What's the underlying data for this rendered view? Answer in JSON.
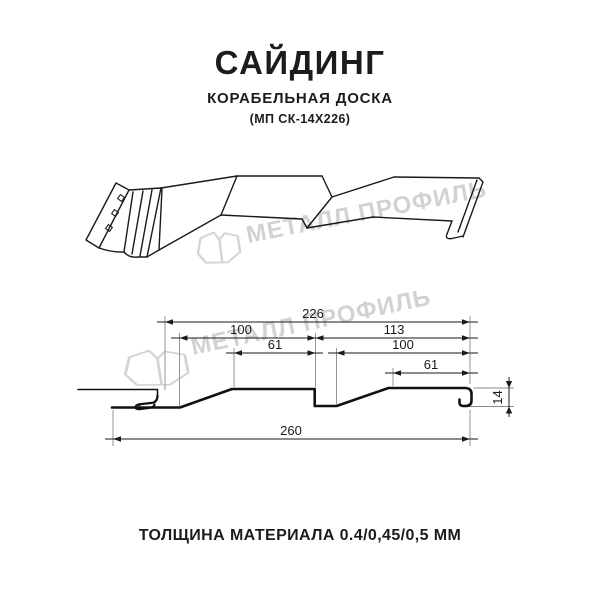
{
  "header": {
    "title": "САЙДИНГ",
    "subtitle": "КОРАБЕЛЬНАЯ ДОСКА",
    "model": "(МП СК-14Х226)"
  },
  "watermark": {
    "text": "МЕТАЛЛ ПРОФИЛЬ",
    "color": "#d2d2d2",
    "logo": "metal-profil-emblem"
  },
  "drawing3d": {
    "description": "perspective line drawing of ship-lap metal siding panel",
    "nail_strip_holes": 3
  },
  "cross_section": {
    "dims": {
      "width": "226",
      "plank1": "100",
      "pitch": "113",
      "top1": "61",
      "plank2": "100",
      "top2": "61",
      "overall": "260",
      "height": "14"
    }
  },
  "footer": {
    "note": "ТОЛЩИНА МАТЕРИАЛА 0.4/0,45/0,5 ММ"
  },
  "colors": {
    "line": "#1a1a1a",
    "text": "#1c1c1c",
    "watermark": "#d2d2d2"
  }
}
